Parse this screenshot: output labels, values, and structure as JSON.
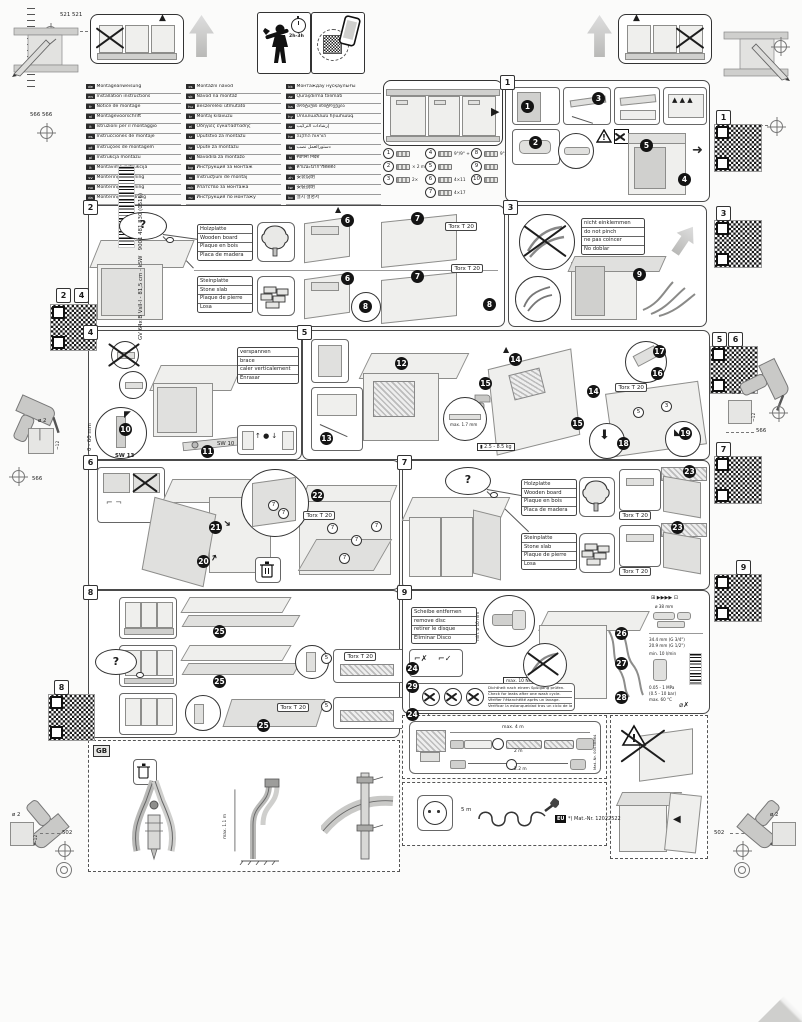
{
  "nums": {
    "n1": "1",
    "n2": "2",
    "n3": "3",
    "n4": "4",
    "n5": "5",
    "n6": "6",
    "n7": "7",
    "n8": "8",
    "n9": "9"
  },
  "steps": {
    "s1": "1",
    "s2": "2",
    "s3": "3",
    "s4": "4",
    "s5": "5",
    "s6": "6",
    "s7": "7",
    "s8": "8",
    "s9": "9",
    "s10": "10",
    "s11": "11",
    "s12": "12",
    "s13": "13",
    "s14": "14",
    "s15": "15",
    "s16": "16",
    "s17": "17",
    "s18": "18",
    "s19": "19",
    "s20": "20",
    "s21": "21",
    "s22": "22",
    "s23": "23",
    "s24": "24",
    "s25": "25",
    "s26": "26",
    "s27": "27",
    "s28": "28",
    "s29": "29"
  },
  "header": {
    "install_time": "2h-3h"
  },
  "margins": {
    "d521": "521 521",
    "d566566": "566 566",
    "d566": "566",
    "d502": "502",
    "drill_dia": "ø 2",
    "drill_depth": "~12",
    "product": "GV 64x B VsII-I - 81,5 cm - kSW",
    "order": "9001 481 830 (0516)"
  },
  "languages": {
    "col1": [
      {
        "c": "de",
        "t": "Montageanweisung",
        "s": "*Über Kundendienst erhältlich"
      },
      {
        "c": "en",
        "t": "Installation instructions",
        "s": "*Available from customer service"
      },
      {
        "c": "fr",
        "t": "Notice de montage",
        "s": "*Disponible auprès du service après-vente"
      },
      {
        "c": "nl",
        "t": "Montagevoorschrift",
        "s": "*Verkrijgbaar via de servicedienst"
      },
      {
        "c": "it",
        "t": "Istruzioni per il montaggio",
        "s": "*Disponibili presso il servizio assistenza clienti"
      },
      {
        "c": "es",
        "t": "Instrucciones de montaje",
        "s": "*Se puede adquirir a través del Servicio de Asistencia Técnica"
      },
      {
        "c": "pt",
        "t": "Instruções de montagem",
        "s": "*Pode ser adquirido no Serviço de Assistência Técnica"
      },
      {
        "c": "pl",
        "t": "Instrukcja montażu",
        "s": "*Można zamówić w autoryzowanym serwisie"
      },
      {
        "c": "lt",
        "t": "Montavimo instrukcija",
        "s": "*Galima įsigyti per klientų aptarnavimą"
      },
      {
        "c": "sv",
        "t": "Monteringsanvisning",
        "s": "*Kan fås via kundtjänst"
      },
      {
        "c": "no",
        "t": "Monteringsanvisning",
        "s": "*Fås hos kundeservice"
      },
      {
        "c": "da",
        "t": "Monteringsvejledning",
        "s": "*Kan købes hos serviceafdelingen"
      },
      {
        "c": "fi",
        "t": "Asennusohje",
        "s": "*Saatavissa huoltopalvelusta"
      }
    ],
    "col2": [
      {
        "c": "cs",
        "t": "Montážní návod",
        "s": "*K dispozici přes servisní službu"
      },
      {
        "c": "sk",
        "t": "Návod na montáž",
        "s": "*Dostupný cez zákaznícky servis"
      },
      {
        "c": "hu",
        "t": "Beszerelési útmutató",
        "s": "*Az ügyfélszolgálaton keresztül szerezhető be"
      },
      {
        "c": "tr",
        "t": "Montaj kılavuzu",
        "s": "*Yetkili servisten temin edilebilir"
      },
      {
        "c": "el",
        "t": "Οδηγίες εγκατάστασης",
        "s": "*Διατίθεται από το σέρβις πελατών"
      },
      {
        "c": "sr",
        "t": "Uputstvo za montažu",
        "s": "*Može se dobiti preko servisne službe"
      },
      {
        "c": "hr",
        "t": "Upute za montažu",
        "s": "*Mogu se dobiti u ovlaštenom servisu"
      },
      {
        "c": "sl",
        "t": "Navodila za montažo",
        "s": "*Na voljo pri servisni službi"
      },
      {
        "c": "bg",
        "t": "Инструкция за монтаж",
        "s": "*Може да се получи от сервиза"
      },
      {
        "c": "ro",
        "t": "Instrucţiuni de montaj",
        "s": "*Disponibile prin serviciul clienţi"
      },
      {
        "c": "mk",
        "t": "Упатство за монтажа",
        "s": "*Достапно преку сервисната служба"
      },
      {
        "c": "ru",
        "t": "Инструкция по монтажу",
        "s": "*Можно получить через сервисную службу"
      },
      {
        "c": "uk",
        "t": "Інструкція з монтажу",
        "s": "*Можна отримати через сервісну службу"
      }
    ],
    "col3": [
      {
        "c": "kk",
        "t": "Монтаждау нұсқаулығы",
        "s": "*Сервис қызметі арқылы алуға болады"
      },
      {
        "c": "az",
        "t": "Quraşdırma təlimatı",
        "s": "*Müştəri xidmətindən əldə etmək olar"
      },
      {
        "c": "ka",
        "t": "მონტაჟის ინსტრუქცია",
        "s": "*ხელმისაწვდომია სერვისცენტრში"
      },
      {
        "c": "hy",
        "t": "Մոնտաժման հրահանգ",
        "s": "*Հասանելի է սպասարկման ծառայությունից"
      },
      {
        "c": "ar",
        "t": "إرشادات التركيب",
        "s": "*متوفرة لدى خدمة العملاء"
      },
      {
        "c": "he",
        "t": "הוראות התקנה",
        "s": "*ניתן להשיג בשירות הלקוחות"
      },
      {
        "c": "fa",
        "t": "دستورالعمل نصب",
        "s": "*از طریق خدمات مشتریان"
      },
      {
        "c": "hi",
        "t": "स्थापना निर्देश",
        "s": "*ग्राहक सेवा से उपलब्ध"
      },
      {
        "c": "th",
        "t": "คำแนะนำการติดตั้ง",
        "s": "*ขอรับได้จากศูนย์บริการ"
      },
      {
        "c": "zh",
        "t": "安装说明",
        "s": "*可通过客户服务获取 (Customer Service)"
      },
      {
        "c": "tw",
        "t": "安裝說明",
        "s": "*可向客戶服務索取"
      },
      {
        "c": "ko",
        "t": "설치 설명서",
        "s": "*고객 서비스에서 제공"
      },
      {
        "c": "ja",
        "t": "設置説明書",
        "s": "*カスタマーサービスより入手可能"
      }
    ]
  },
  "parts": {
    "col1": [
      {
        "id": "1",
        "qty": ""
      },
      {
        "id": "2",
        "qty": "× 2 m"
      },
      {
        "id": "3",
        "qty": "2×"
      }
    ],
    "col2": [
      {
        "id": "4",
        "qty": "9°/9° + a×b"
      },
      {
        "id": "5",
        "qty": ""
      },
      {
        "id": "6",
        "qty": "4×11"
      },
      {
        "id": "7",
        "qty": "4×17"
      }
    ],
    "col3": [
      {
        "id": "8",
        "qty": "9°/9° + a×b"
      },
      {
        "id": "9",
        "qty": ""
      },
      {
        "id": "10",
        "qty": ""
      }
    ]
  },
  "materials": {
    "wood": [
      "Holzplatte",
      "Wooden board",
      "Plaque en bois",
      "Placa de madera"
    ],
    "stone": [
      "Steinplatte",
      "Stone slab",
      "Plaque de pierre",
      "Losa"
    ]
  },
  "common": {
    "torx": "Torx T 20",
    "question": "?"
  },
  "panel3": {
    "warn": [
      "nicht einklemmen",
      "do not pinch",
      "ne pas coincer",
      "No doblar"
    ]
  },
  "panel4": {
    "labels": [
      "verspannen",
      "brace",
      "caler verticalement",
      "Enrasar"
    ],
    "range": "0 - 60 mm",
    "sw13": "SW 13",
    "sw10": "SW 10"
  },
  "panel5": {
    "gap": "max. 1.7 mm",
    "weight": "2.5 - 8.5 kg"
  },
  "panel9": {
    "remove": [
      "Scheibe entfernen",
      "remove disc",
      "retirer le disque",
      "Eliminar Disco"
    ],
    "torque": "max. 10 Nm",
    "min_dia": "min. ø 10 mm",
    "leak": [
      "Dichtheit nach einem Spülgang prüfen.",
      "Check for leaks after one wash cycle.",
      "Vérifier l'étanchéité après un lavage.",
      "Verificar la estanqueidad tras un ciclo de lavado."
    ],
    "dia": "ø 38 mm",
    "g34": "34.4 mm (G 3/4\")",
    "g12": "20.9 mm (G 1/2\")",
    "flow": "min. 10 l/min",
    "pressure": "0.05 - 1 MPa",
    "pressure_bar": "(0.5 - 10 bar)",
    "temp": "max. 60 °C"
  },
  "gb": {
    "label": "GB",
    "dim": "max. 1.1 m"
  },
  "hose_kit": {
    "total": "max. 4 m",
    "seg1": "2 m",
    "seg2": "2.2 m",
    "mat": "Mat.-Nr. 00038864"
  },
  "power_kit": {
    "length": "5 m",
    "region": "EU",
    "mat": "*) Mat.-Nr. 12022522"
  }
}
